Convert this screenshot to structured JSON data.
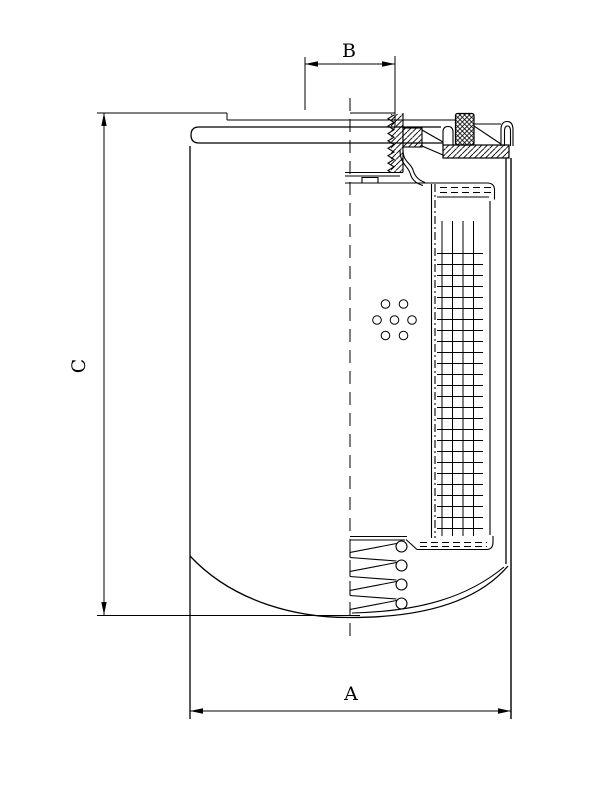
{
  "page": {
    "background_color": "#ffffff",
    "ink_color": "#000000"
  },
  "drawing": {
    "kind": "technical section drawing, spin-on filter cartridge",
    "dimensions": {
      "a": {
        "label": "A",
        "orientation": "horizontal",
        "measures": "outer diameter of can"
      },
      "b": {
        "label": "B",
        "orientation": "horizontal",
        "measures": "thread diameter at top port"
      },
      "c": {
        "label": "C",
        "orientation": "vertical",
        "measures": "overall height"
      }
    },
    "parts": [
      "outer-can",
      "top-baseplate",
      "threaded-port",
      "gasket-seal",
      "rolled-seam",
      "filter-media-pleats",
      "center-tube",
      "end-caps",
      "coil-spring",
      "perforation-holes",
      "dome-bottom",
      "centerline"
    ]
  }
}
